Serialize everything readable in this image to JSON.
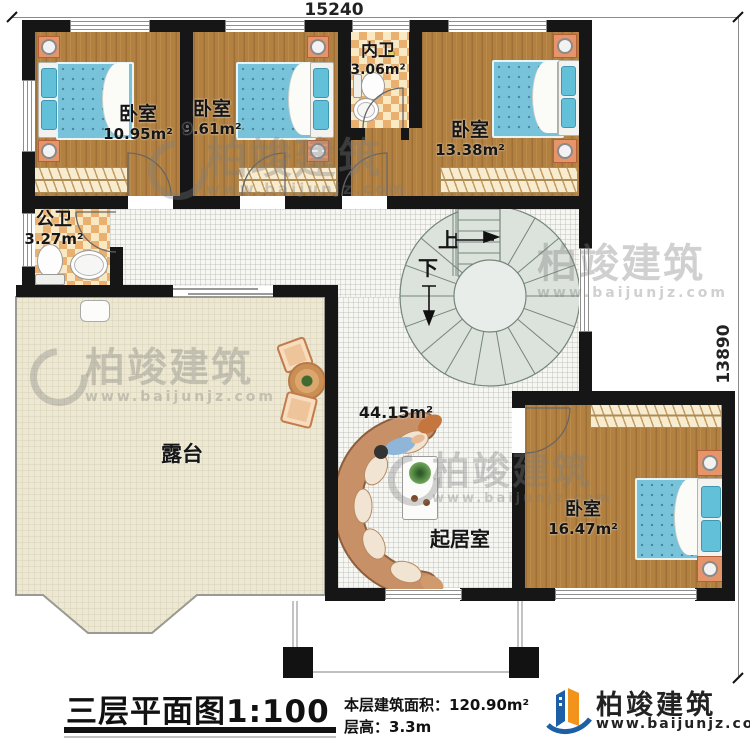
{
  "dimensions": {
    "width": "15240",
    "height": "13890"
  },
  "rooms": {
    "bedroom_top_left": {
      "label": "卧室",
      "area": "10.95m²"
    },
    "bedroom_top_mid": {
      "label": "卧室",
      "area": "9.61m²"
    },
    "bath_inner": {
      "label": "内卫",
      "area": "3.06m²"
    },
    "bedroom_top_right": {
      "label": "卧室",
      "area": "13.38m²"
    },
    "bath_public": {
      "label": "公卫",
      "area": "3.27m²"
    },
    "terrace": {
      "label": "露台"
    },
    "living": {
      "label": "起居室",
      "area": "44.15m²"
    },
    "bedroom_bottom": {
      "label": "卧室",
      "area": "16.47m²"
    }
  },
  "stairs": {
    "up": "上",
    "down": "下"
  },
  "title_block": {
    "title": "三层平面图",
    "scale": "1:100",
    "area_label": "本层建筑面积：",
    "area_value": "120.90m²",
    "height_label": "层高：",
    "height_value": "3.3m"
  },
  "branding": {
    "name": "柏竣建筑",
    "url": "www.baijunjz.com"
  },
  "colors": {
    "brand_blue": "#1d5fa6",
    "brand_orange": "#f2941c",
    "wall": "#161616"
  }
}
